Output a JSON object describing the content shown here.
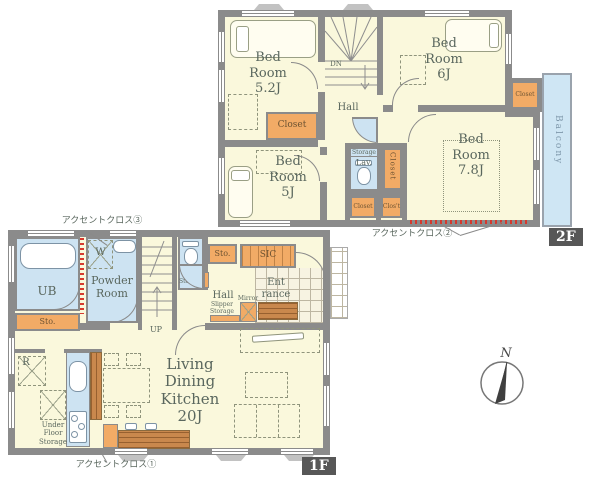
{
  "colors": {
    "floor": "#faf8dc",
    "wall": "#8b8b8b",
    "wet_area": "#cde3f2",
    "closet": "#f2ab66",
    "wood": "#c9884d",
    "balcony": "#cfe6f4",
    "accent_wall": "#d6392e",
    "badge_bg": "#575757"
  },
  "common": {
    "closet": "Closet",
    "sto": "Sto.",
    "storage": "Storage",
    "lav": "Lav.",
    "hall": "Hall"
  },
  "floor2": {
    "badge": "2F",
    "bedroom_5_2": "Bed\nRoom\n5.2J",
    "bedroom_6": "Bed\nRoom\n6J",
    "bedroom_7_8": "Bed\nRoom\n7.8J",
    "bedroom_5": "Bed\nRoom\n5J",
    "down": "DN",
    "closet_abbr": "Clos't",
    "balcony": "Balcony",
    "accent_label": "アクセントクロス②"
  },
  "floor1": {
    "badge": "1F",
    "unit_bath": "UB",
    "washer": "W",
    "powder_room": "Powder\nRoom",
    "up": "UP",
    "sic": "SIC",
    "entrance": "Ent\nrance",
    "mirror": "Mirror",
    "slipper_storage": "Slipper\nStorage",
    "ldk": "Living\nDining\nKitchen\n20J",
    "refrigerator": "R",
    "under_floor_storage": "Under\nFloor\nStorage",
    "accent_label_1": "アクセントクロス①",
    "accent_label_3": "アクセントクロス③"
  },
  "compass": {
    "north": "N"
  }
}
